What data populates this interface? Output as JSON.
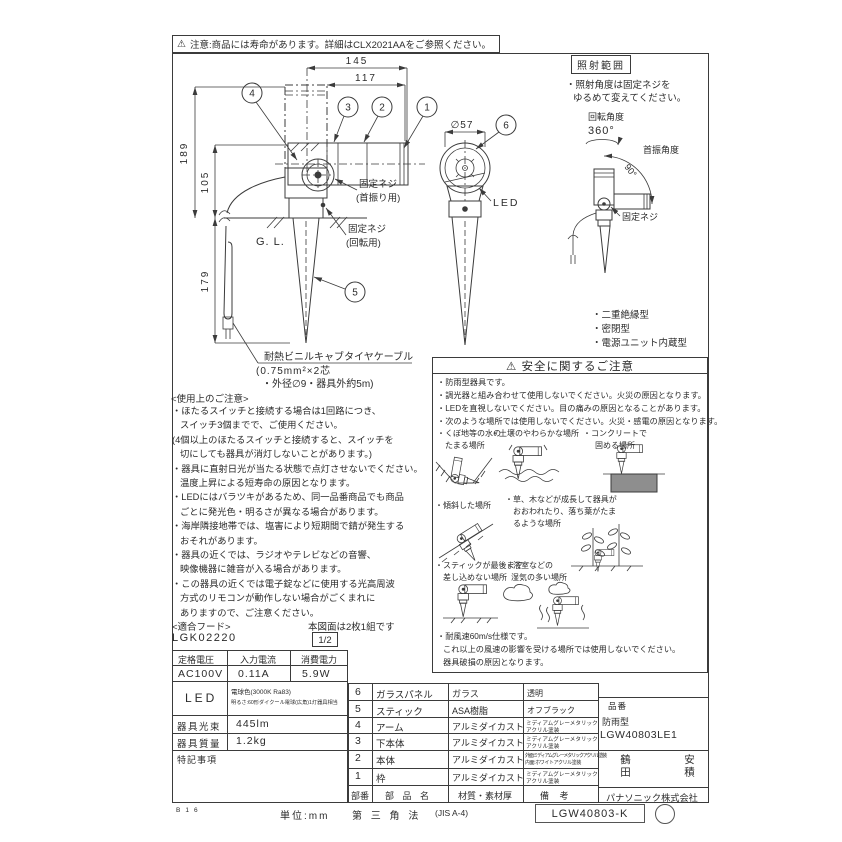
{
  "icons": {
    "warning": "⚠"
  },
  "top_note": {
    "text": "注意:商品には寿命があります。詳細はCLX2021AAをご参照ください。"
  },
  "drawing": {
    "dim_145": "145",
    "dim_117": "117",
    "dim_189": "189",
    "dim_105": "105",
    "dim_179": "179",
    "dim_dia57": "∅57",
    "balloon_1": "1",
    "balloon_2": "2",
    "balloon_3": "3",
    "balloon_4": "4",
    "balloon_5": "5",
    "balloon_6": "6",
    "gl_label": "G. L.",
    "fix_screw_swing_1": "固定ネジ",
    "fix_screw_swing_2": "(首振り用)",
    "fix_screw_rotate_1": "固定ネジ",
    "fix_screw_rotate_2": "(回転用)",
    "led_label": "LED",
    "cable_note_1": "耐熱ビニルキャブタイヤケーブル",
    "cable_note_2": "(0.75mm²×2芯",
    "cable_note_3": "・外径∅9・器具外約5m)"
  },
  "beam_range": {
    "title": "照射範囲",
    "note_line1": "・照射角度は固定ネジを",
    "note_line2": "ゆるめて変えてください。",
    "rotation_label": "回転角度",
    "rotation_angle": "360°",
    "swing_label": "首振角度",
    "swing_angle": "90°",
    "fix_screw": "固定ネジ"
  },
  "features": {
    "item1": "・二重絶縁型",
    "item2": "・密閉型",
    "item3": "・電源ユニット内蔵型"
  },
  "usage_notes": {
    "title": "<使用上のご注意>",
    "lines": [
      "・ほたるスイッチと接続する場合は1回路につき、",
      "スイッチ3個までで、ご使用ください。",
      "(4個以上のほたるスイッチと接続すると、スイッチを",
      "切にしても器具が消灯しないことがあります。)",
      "・器具に直射日光が当たる状態で点灯させないでください。",
      "温度上昇による短寿命の原因となります。",
      "・LEDにはバラツキがあるため、同一品番商品でも商品",
      "ごとに発光色・明るさが異なる場合があります。",
      "・海岸隣接地帯では、塩害により短期間で錆が発生する",
      "おそれがあります。",
      "・器具の近くでは、ラジオやテレビなどの音響、",
      "映像機器に雑音が入る場合があります。",
      "・この器具の近くでは電子錠などに使用する光高周波",
      "方式のリモコンが動作しない場合がごくまれに",
      "ありますので、ご注意ください。"
    ],
    "hood_label": "<適合フード>",
    "hood_model": "LGK02220",
    "set_note": "本図面は2枚1組です",
    "sheet_no": "1/2"
  },
  "safety": {
    "title": "安全に関するご注意",
    "lines": [
      "・防雨型器具です。",
      "・調光器と組み合わせて使用しないでください。火災の原因となります。",
      "・LEDを直視しないでください。目の痛みの原因となることがあります。",
      "・次のような場所では使用しないでください。火災・感電の原因となります。"
    ],
    "loc_hollow_1": "・くぼ地等の水の",
    "loc_hollow_2": "たまる場所",
    "loc_soil": "・土壌のやわらかな場所",
    "loc_concrete_1": "・コンクリートで",
    "loc_concrete_2": "固める場所",
    "loc_slope": "・傾斜した場所",
    "loc_plants_1": "・草、木などが成長して器具が",
    "loc_plants_2": "おおわれたり、落ち葉がたま",
    "loc_plants_3": "るような場所",
    "loc_stick_1": "・スティックが最後まで",
    "loc_stick_2": "差し込めない場所",
    "loc_bath_1": "・浴室などの",
    "loc_bath_2": "湿気の多い場所",
    "wind_1": "・耐風速60m/s仕様です。",
    "wind_2": "これ以上の風速の影響を受ける場所では使用しないでください。",
    "wind_3": "器具破損の原因となります。"
  },
  "spec_table": {
    "col_voltage": "定格電圧",
    "col_current": "入力電流",
    "col_power": "消費電力",
    "voltage": "AC100V",
    "current": "0.11A",
    "power": "5.9W",
    "led_label": "LED",
    "led_color": "電球色(3000K Ra83)",
    "led_brightness": "明るさ:60形ダイクール電球(広角)1灯器具相当",
    "flux_label": "器具光束",
    "flux_value": "445lm",
    "weight_label": "器具質量",
    "weight_value": "1.2kg",
    "notes_label": "特記事項"
  },
  "parts_table": {
    "rows": [
      {
        "no": "6",
        "name": "ガラスパネル",
        "material": "ガラス",
        "remark1": "透明",
        "remark2": ""
      },
      {
        "no": "5",
        "name": "スティック",
        "material": "ASA樹脂",
        "remark1": "オフブラック",
        "remark2": ""
      },
      {
        "no": "4",
        "name": "アーム",
        "material": "アルミダイカスト",
        "remark1": "ミディアムグレーメタリック",
        "remark2": "アクリル塗装"
      },
      {
        "no": "3",
        "name": "下本体",
        "material": "アルミダイカスト",
        "remark1": "ミディアムグレーメタリック",
        "remark2": "アクリル塗装"
      },
      {
        "no": "2",
        "name": "本体",
        "material": "アルミダイカスト",
        "remark1": "外面:ミディアムグレーメタリックアクリル塗装",
        "remark2": "内面:ホワイトアクリル塗装"
      },
      {
        "no": "1",
        "name": "枠",
        "material": "アルミダイカスト",
        "remark1": "ミディアムグレーメタリック",
        "remark2": "アクリル塗装"
      }
    ],
    "header_no": "部番",
    "header_name": "部 品 名",
    "header_material": "材質・素材厚",
    "header_remark": "備  考"
  },
  "title_block": {
    "model_label": "品番",
    "type": "防雨型",
    "model": "LGW40803LE1",
    "stamp_left": "鶴田",
    "stamp_right": "安積",
    "company": "パナソニック株式会社"
  },
  "footer": {
    "code": "B16",
    "unit": "単位:mm",
    "projection": "第 三 角 法",
    "sheet_size": "(JIS A-4)",
    "doc_number": "LGW40803-K"
  }
}
